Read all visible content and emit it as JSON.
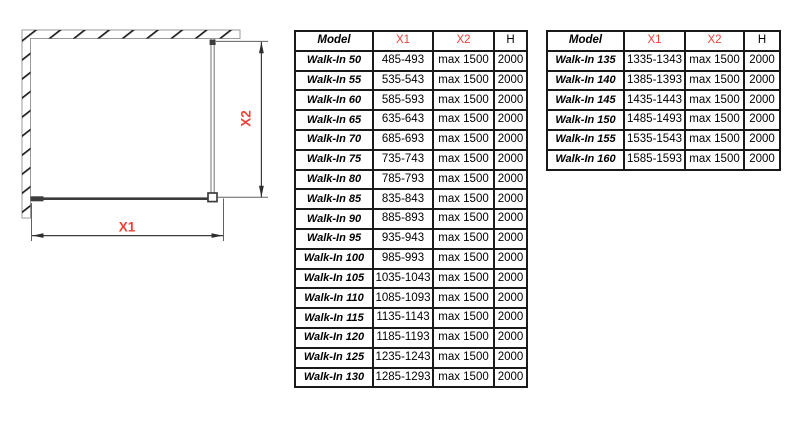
{
  "colors": {
    "accent_red": "#f04238",
    "diagram_line": "#3c3c3c",
    "table_border": "#1a1a1a"
  },
  "diagram": {
    "label_x1": "X1",
    "label_x2": "X2"
  },
  "tables": [
    {
      "headers": {
        "model": "Model",
        "x1": "X1",
        "x2": "X2",
        "h": "H"
      },
      "rows": [
        {
          "model": "Walk-In 50",
          "x1": "485-493",
          "x2": "max 1500",
          "h": "2000"
        },
        {
          "model": "Walk-In 55",
          "x1": "535-543",
          "x2": "max 1500",
          "h": "2000"
        },
        {
          "model": "Walk-In 60",
          "x1": "585-593",
          "x2": "max 1500",
          "h": "2000"
        },
        {
          "model": "Walk-In 65",
          "x1": "635-643",
          "x2": "max 1500",
          "h": "2000"
        },
        {
          "model": "Walk-In 70",
          "x1": "685-693",
          "x2": "max 1500",
          "h": "2000"
        },
        {
          "model": "Walk-In 75",
          "x1": "735-743",
          "x2": "max 1500",
          "h": "2000"
        },
        {
          "model": "Walk-In 80",
          "x1": "785-793",
          "x2": "max 1500",
          "h": "2000"
        },
        {
          "model": "Walk-In 85",
          "x1": "835-843",
          "x2": "max 1500",
          "h": "2000"
        },
        {
          "model": "Walk-In 90",
          "x1": "885-893",
          "x2": "max 1500",
          "h": "2000"
        },
        {
          "model": "Walk-In 95",
          "x1": "935-943",
          "x2": "max 1500",
          "h": "2000"
        },
        {
          "model": "Walk-In 100",
          "x1": "985-993",
          "x2": "max 1500",
          "h": "2000"
        },
        {
          "model": "Walk-In 105",
          "x1": "1035-1043",
          "x2": "max 1500",
          "h": "2000"
        },
        {
          "model": "Walk-In 110",
          "x1": "1085-1093",
          "x2": "max 1500",
          "h": "2000"
        },
        {
          "model": "Walk-In 115",
          "x1": "1135-1143",
          "x2": "max 1500",
          "h": "2000"
        },
        {
          "model": "Walk-In 120",
          "x1": "1185-1193",
          "x2": "max 1500",
          "h": "2000"
        },
        {
          "model": "Walk-In 125",
          "x1": "1235-1243",
          "x2": "max 1500",
          "h": "2000"
        },
        {
          "model": "Walk-In 130",
          "x1": "1285-1293",
          "x2": "max 1500",
          "h": "2000"
        }
      ]
    },
    {
      "headers": {
        "model": "Model",
        "x1": "X1",
        "x2": "X2",
        "h": "H"
      },
      "rows": [
        {
          "model": "Walk-In 135",
          "x1": "1335-1343",
          "x2": "max 1500",
          "h": "2000"
        },
        {
          "model": "Walk-In 140",
          "x1": "1385-1393",
          "x2": "max 1500",
          "h": "2000"
        },
        {
          "model": "Walk-In 145",
          "x1": "1435-1443",
          "x2": "max 1500",
          "h": "2000"
        },
        {
          "model": "Walk-In 150",
          "x1": "1485-1493",
          "x2": "max 1500",
          "h": "2000"
        },
        {
          "model": "Walk-In 155",
          "x1": "1535-1543",
          "x2": "max 1500",
          "h": "2000"
        },
        {
          "model": "Walk-In 160",
          "x1": "1585-1593",
          "x2": "max 1500",
          "h": "2000"
        }
      ]
    }
  ]
}
